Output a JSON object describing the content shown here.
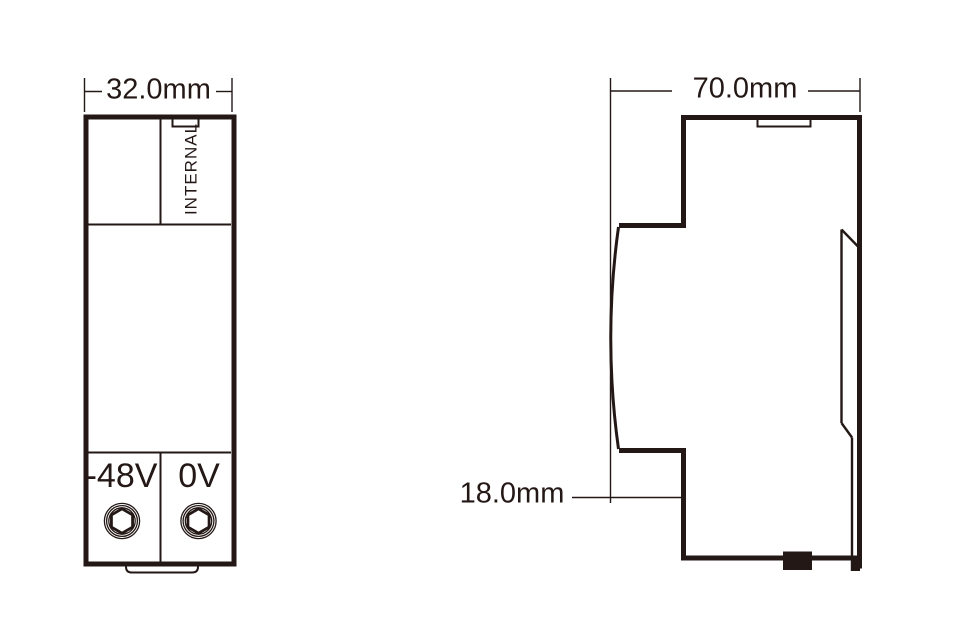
{
  "drawing_type": "technical-dimension-diagram",
  "front_view": {
    "width_dimension": "32.0mm",
    "panel_label": "INTERNAL",
    "terminal_left": "-48V",
    "terminal_right": "0V"
  },
  "side_view": {
    "depth_dimension": "70.0mm",
    "rail_dimension": "18.0mm"
  },
  "colors": {
    "ink": "#231815",
    "paper": "#ffffff"
  },
  "icons": [
    {
      "name": "hex-screw-left-icon",
      "shape": "hex-socket-screw-head"
    },
    {
      "name": "hex-screw-right-icon",
      "shape": "hex-socket-screw-head"
    }
  ]
}
